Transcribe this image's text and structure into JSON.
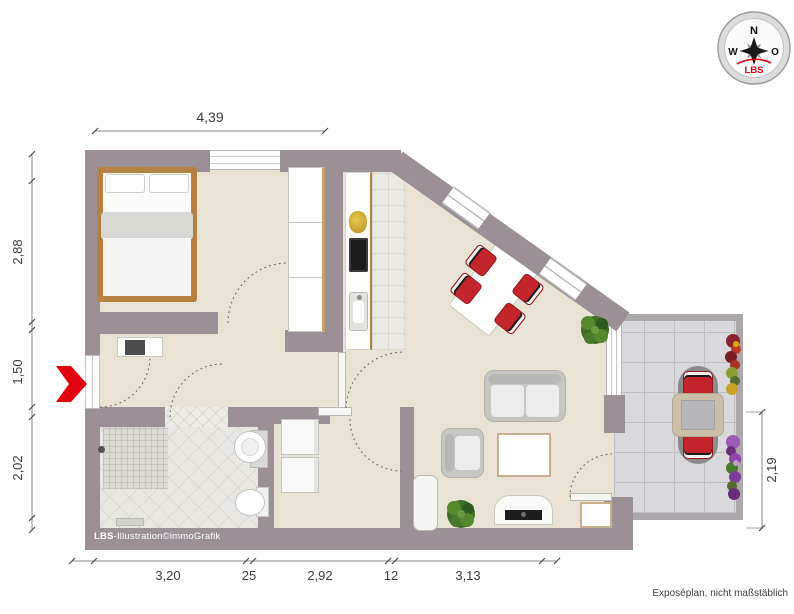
{
  "compass": {
    "n": "N",
    "w": "W",
    "o": "O",
    "brand": "LBS"
  },
  "dimensions": {
    "top": "4,39",
    "left": [
      "2,88",
      "1,50",
      "2,02"
    ],
    "bottom": [
      "3,20",
      "25",
      "2,92",
      "12",
      "3,13"
    ],
    "right": "2,19"
  },
  "credit": {
    "brand": "LBS",
    "text": "-Illustration©immoGrafik"
  },
  "disclaimer": "Exposéplan, nicht maßstäblich",
  "colors": {
    "wall": "#9a9096",
    "floor": "#e9e3d6",
    "accent_red": "#e3000f",
    "chair_red": "#c4242b",
    "wood": "#b5823f",
    "terrace_tile": "#d9d9db"
  }
}
